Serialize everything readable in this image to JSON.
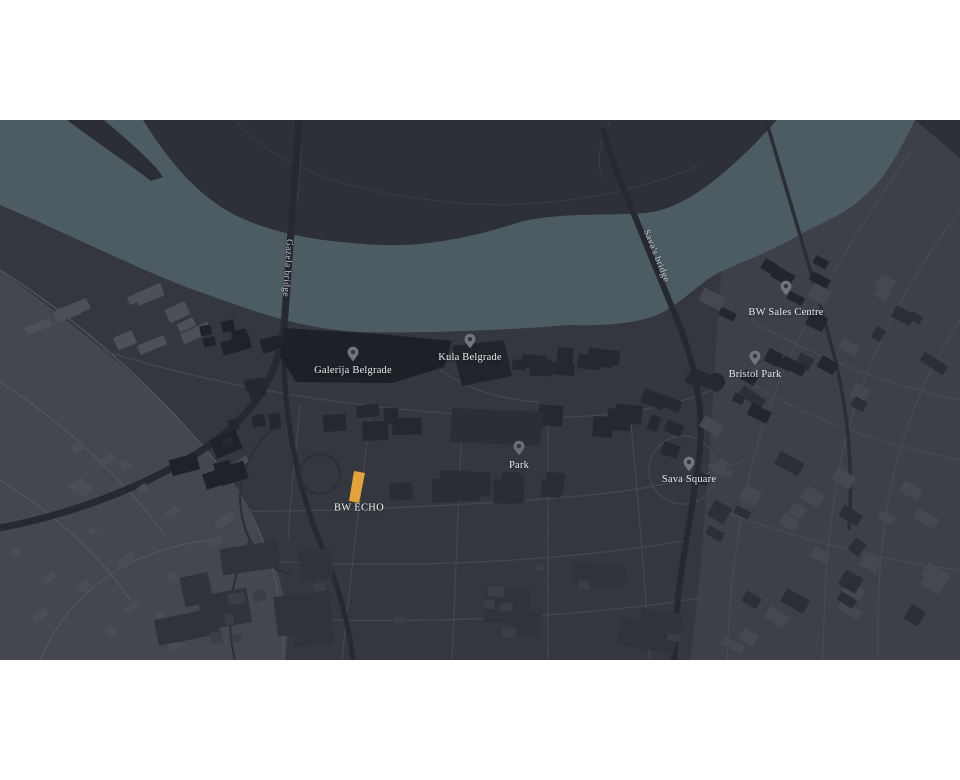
{
  "map": {
    "title": "Belgrade Waterfront area map",
    "pois": [
      {
        "id": "galerija-belgrade",
        "label": "Galerija Belgrade"
      },
      {
        "id": "kula-belgrade",
        "label": "Kula Belgrade"
      },
      {
        "id": "bw-sales-centre",
        "label": "BW Sales Centre"
      },
      {
        "id": "bristol-park",
        "label": "Bristol Park"
      },
      {
        "id": "park",
        "label": "Park"
      },
      {
        "id": "sava-square",
        "label": "Sava Square"
      }
    ],
    "bridges": [
      {
        "id": "gazela",
        "label": "Gazela bridge"
      },
      {
        "id": "savas",
        "label": "Sava's bridge"
      }
    ],
    "highlight": {
      "id": "bw-echo",
      "label": "BW ECHO",
      "color": "#e2a33d"
    },
    "colors": {
      "water": "#4d5b63",
      "land": "#34373d",
      "north_bank": "#2d3036",
      "old_town": "#3d4047",
      "land_light": "#44474d",
      "building_dark": "#24272d",
      "highway": "#26292f",
      "pin": "#72767c",
      "label_text": "#e9ebec"
    }
  }
}
